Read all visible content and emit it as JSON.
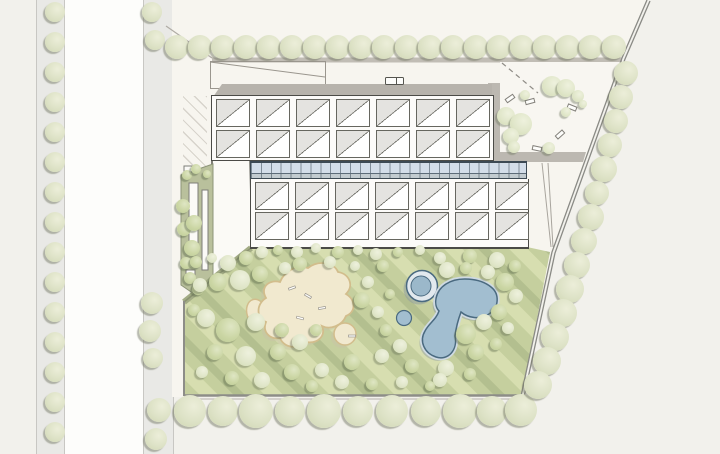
{
  "meta": {
    "drawing_type": "architectural site plan",
    "title": "",
    "visible_text": "none"
  },
  "palette": {
    "background": "#f2f1ec",
    "between_roads": "#fdfdfb",
    "road": "#e9e9e6",
    "road_edge": "#c8c7c3",
    "parcel": "#f7f5ef",
    "boundary_bar": "#c1bdb5",
    "roof_band": "#b7b3ac",
    "building_bg": "#fcfbf9",
    "outline": "#4b4b47",
    "skylight_gray": "#e4e3e0",
    "glazing_blue_top": "#d3dde9",
    "glazing_blue_bottom": "#c2cbd0",
    "court_floor": "#f8f6f1",
    "court_band": "#bcb8b1",
    "lawn_light": "#d7deb0",
    "lawn_mid": "#c5cf9e",
    "lawn_dark": "#b3bf8f",
    "sand_fill": "#f1e9cf",
    "sand_edge": "#d2bd8c",
    "pond_fill": "#a2bed0",
    "pond_rim": "#cfdae2",
    "pond_edge": "#4a6a80",
    "pool_ring": "#e2e9ee",
    "pool_inner": "#9bb8ca",
    "planting_strip": "#b9c09c"
  },
  "roads": [
    {
      "name": "street-west-outer",
      "x": 36,
      "w": 27
    },
    {
      "name": "street-west-inner",
      "x": 143,
      "w": 29
    }
  ],
  "between_roads": {
    "x": 63,
    "w": 80
  },
  "ground": {
    "parcel_points": "172,0 647,0 622,58 552,252 521,397 172,397",
    "boundary_a": "647,0 622,58 552,252 521,396",
    "boundary_b": "650,1 625,59 555,253 524,397",
    "nw_corner_line": {
      "x1": 166,
      "y1": 26,
      "x2": 212,
      "y2": 58
    },
    "top_bar": {
      "x": 212,
      "y": 57.5,
      "w": 410,
      "h": 5
    },
    "court_floor_points": "500,62 621,62 585,157 500,157",
    "court_band_left": "488,83 500,83 500,162 488,162",
    "court_band_bottom": "488,152 586,152 583,162 488,162",
    "court_dashed_path": {
      "x1": 502,
      "y1": 63,
      "x2": 538,
      "y2": 93
    },
    "wedge_lines": [
      {
        "x1": 542,
        "y1": 163,
        "x2": 551,
        "y2": 247
      },
      {
        "x1": 548,
        "y1": 163,
        "x2": 553,
        "y2": 247
      }
    ],
    "west_wing_points": "212,158 250,158 252,248 212,278",
    "strip_points": "181,175 213,164 213,281 197,296 181,285",
    "strip_slots": [
      [
        189,
        183,
        9,
        60
      ],
      [
        202,
        190,
        6,
        80
      ],
      [
        184,
        166,
        8,
        6
      ],
      [
        186,
        270,
        9,
        7
      ],
      [
        194,
        281,
        9,
        7
      ]
    ],
    "annotation_diagonal": {
      "x1": 210,
      "y1": 62,
      "x2": 325,
      "y2": 77
    },
    "lawn_points": "252,247 527,247 550,252 522,396 184,396 184,302",
    "lawn_edges": {
      "diagonal": {
        "x1": 251,
        "y1": 248,
        "x2": 184,
        "y2": 302
      },
      "bottom": {
        "x1": 184,
        "y1": 395.5,
        "x2": 522,
        "y2": 395.5
      },
      "bottom2": {
        "x1": 184,
        "y1": 399,
        "x2": 521,
        "y2": 399
      },
      "left": {
        "x1": 184,
        "y1": 301,
        "x2": 184,
        "y2": 396
      }
    },
    "sand_arm": {
      "cx": 257,
      "cy": 313,
      "rx": 10,
      "ry": 14,
      "rot": -18
    },
    "sand_path": "M266,298 C260,288 268,279 280,282 C284,272 296,264 308,268 C318,260 334,262 338,272 C350,274 354,286 346,294 C356,300 356,312 346,316 C342,326 330,330 322,326 C326,336 318,344 306,342 C298,350 284,348 280,338 C270,340 262,332 266,322 C256,318 256,304 266,298 Z",
    "sand_circle": {
      "cx": 345,
      "cy": 334,
      "r": 11
    },
    "sand_dashes": [
      [
        292,
        288,
        -20
      ],
      [
        308,
        296,
        30
      ],
      [
        322,
        308,
        -10
      ],
      [
        300,
        318,
        15
      ],
      [
        352,
        336,
        0
      ]
    ],
    "pond_path": "M446,284 C458,276 480,278 491,287 C500,294 499,308 489,314 C480,320 468,318 461,312 C458,320 456,328 455,336 C458,350 448,361 436,357 C424,353 419,341 425,331 C429,323 436,320 439,311 C433,305 435,291 446,284 Z",
    "pool_ring": {
      "cx": 422,
      "cy": 286,
      "r_outer": 15.5,
      "r_inner": 10
    },
    "pond_small": {
      "cx": 404,
      "cy": 318,
      "r": 7.5
    }
  },
  "building": {
    "annotation_rect": {
      "x": 210,
      "y": 61,
      "w": 114,
      "h": 26
    },
    "roof_vent": {
      "x": 385,
      "y": 77,
      "w": 17,
      "h": 6
    },
    "block_a": {
      "x": 211,
      "y": 95,
      "x0": 4,
      "y0": 3,
      "cell_w": 32,
      "cell_h": 26,
      "pitch_x": 40,
      "pitch_y": 31,
      "cols": 7,
      "rows": 2
    },
    "block_b": {
      "x": 250,
      "y": 179,
      "x0": 4,
      "y0": 3,
      "cell_w": 32,
      "cell_h": 26,
      "pitch_x": 40,
      "pitch_y": 30,
      "cols": 7,
      "rows": 2
    }
  },
  "benches": [
    [
      509,
      97,
      -35
    ],
    [
      529,
      100,
      -15
    ],
    [
      571,
      106,
      22
    ],
    [
      559,
      133,
      -42
    ],
    [
      536,
      147,
      12
    ]
  ],
  "trees": [
    {
      "group": "street-trees-outer",
      "tone": "street",
      "items": [
        [
          55,
          12,
          10
        ],
        [
          55,
          42,
          10
        ],
        [
          55,
          72,
          10
        ],
        [
          55,
          102,
          10
        ],
        [
          55,
          132,
          10
        ],
        [
          55,
          162,
          10
        ],
        [
          55,
          192,
          10
        ],
        [
          55,
          222,
          10
        ],
        [
          55,
          252,
          10
        ],
        [
          55,
          282,
          10
        ],
        [
          55,
          312,
          10
        ],
        [
          55,
          342,
          10
        ],
        [
          55,
          372,
          10
        ],
        [
          55,
          402,
          10
        ],
        [
          55,
          432,
          10
        ]
      ]
    },
    {
      "group": "street-trees-inner",
      "tone": "street",
      "items": [
        [
          152,
          12,
          10
        ],
        [
          155,
          40,
          10
        ],
        [
          152,
          303,
          11
        ],
        [
          150,
          331,
          11
        ],
        [
          153,
          358,
          10
        ],
        [
          159,
          410,
          12
        ],
        [
          156,
          439,
          11
        ]
      ]
    },
    {
      "group": "tree-row-north",
      "tone": "street",
      "items": [
        [
          177,
          47,
          12
        ],
        [
          200,
          47,
          12
        ],
        [
          223,
          47,
          12
        ],
        [
          246,
          47,
          12
        ],
        [
          269,
          47,
          12
        ],
        [
          292,
          47,
          12
        ],
        [
          315,
          47,
          12
        ],
        [
          338,
          47,
          12
        ],
        [
          361,
          47,
          12
        ],
        [
          384,
          47,
          12
        ],
        [
          407,
          47,
          12
        ],
        [
          430,
          47,
          12
        ],
        [
          453,
          47,
          12
        ],
        [
          476,
          47,
          12
        ],
        [
          499,
          47,
          12
        ],
        [
          522,
          47,
          12
        ],
        [
          545,
          47,
          12
        ],
        [
          568,
          47,
          12
        ],
        [
          591,
          47,
          12
        ],
        [
          614,
          47,
          12
        ]
      ]
    },
    {
      "group": "tree-row-south",
      "tone": "street",
      "items": [
        [
          190,
          411,
          16
        ],
        [
          223,
          411,
          15
        ],
        [
          256,
          411,
          17
        ],
        [
          290,
          411,
          15
        ],
        [
          324,
          411,
          17
        ],
        [
          358,
          411,
          15
        ],
        [
          392,
          411,
          16
        ],
        [
          426,
          411,
          15
        ],
        [
          460,
          411,
          17
        ],
        [
          492,
          411,
          15
        ],
        [
          521,
          410,
          16
        ]
      ]
    },
    {
      "group": "tree-row-east-boundary",
      "tone": "street",
      "items": [
        [
          626,
          73,
          12
        ],
        [
          621,
          97,
          12
        ],
        [
          616,
          121,
          12
        ],
        [
          610,
          145,
          12
        ],
        [
          604,
          169,
          13
        ],
        [
          597,
          193,
          12
        ],
        [
          591,
          217,
          13
        ],
        [
          584,
          241,
          13
        ],
        [
          577,
          265,
          13
        ],
        [
          570,
          289,
          14
        ],
        [
          563,
          313,
          14
        ],
        [
          555,
          337,
          14
        ],
        [
          547,
          361,
          14
        ],
        [
          538,
          385,
          14
        ]
      ]
    },
    {
      "group": "courtyard-trees",
      "tone": "pale",
      "items": [
        [
          552,
          86,
          10
        ],
        [
          566,
          88,
          9
        ],
        [
          578,
          96,
          6
        ],
        [
          525,
          95,
          5
        ],
        [
          506,
          116,
          9
        ],
        [
          521,
          124,
          11
        ],
        [
          511,
          136,
          8
        ],
        [
          514,
          147,
          6
        ],
        [
          549,
          148,
          6
        ],
        [
          566,
          112,
          5
        ],
        [
          583,
          104,
          4
        ]
      ]
    },
    {
      "group": "planting-strip-trees",
      "tone": "mid",
      "items": [
        [
          187,
          175,
          5
        ],
        [
          196,
          169,
          5
        ],
        [
          183,
          206,
          7
        ],
        [
          184,
          229,
          7
        ],
        [
          194,
          223,
          8
        ],
        [
          192,
          248,
          8
        ],
        [
          186,
          263,
          6
        ],
        [
          190,
          278,
          6
        ],
        [
          198,
          289,
          6
        ],
        [
          207,
          174,
          4
        ]
      ]
    },
    {
      "group": "lawn-trees",
      "tone": "mix",
      "items": [
        [
          262,
          252,
          6,
          "pale"
        ],
        [
          278,
          250,
          5,
          "mid"
        ],
        [
          297,
          252,
          6,
          "pale"
        ],
        [
          316,
          248,
          5,
          "pale"
        ],
        [
          338,
          252,
          6,
          "mid"
        ],
        [
          358,
          250,
          5,
          "pale"
        ],
        [
          376,
          254,
          6,
          "pale"
        ],
        [
          398,
          252,
          5,
          "mid"
        ],
        [
          420,
          250,
          5,
          "pale"
        ],
        [
          300,
          264,
          7,
          "mid"
        ],
        [
          330,
          262,
          6,
          "pale"
        ],
        [
          355,
          266,
          5,
          "pale"
        ],
        [
          383,
          266,
          6,
          "mid"
        ],
        [
          440,
          258,
          6,
          "pale"
        ],
        [
          470,
          256,
          7,
          "mid"
        ],
        [
          497,
          260,
          8,
          "pale"
        ],
        [
          515,
          266,
          6,
          "mid"
        ],
        [
          196,
          262,
          6,
          "mid"
        ],
        [
          212,
          258,
          5,
          "pale"
        ],
        [
          228,
          263,
          8,
          "pale"
        ],
        [
          246,
          258,
          7,
          "mid"
        ],
        [
          200,
          285,
          7,
          "pale"
        ],
        [
          218,
          282,
          9,
          "mid"
        ],
        [
          240,
          280,
          10,
          "pale"
        ],
        [
          260,
          274,
          8,
          "mid"
        ],
        [
          194,
          310,
          6,
          "mid"
        ],
        [
          206,
          318,
          9,
          "pale"
        ],
        [
          228,
          330,
          12,
          "mid"
        ],
        [
          256,
          322,
          9,
          "pale"
        ],
        [
          215,
          352,
          8,
          "mid"
        ],
        [
          246,
          356,
          10,
          "pale"
        ],
        [
          278,
          352,
          8,
          "mid"
        ],
        [
          202,
          372,
          6,
          "pale"
        ],
        [
          232,
          378,
          7,
          "mid"
        ],
        [
          262,
          380,
          8,
          "pale"
        ],
        [
          285,
          268,
          6,
          "pale"
        ],
        [
          282,
          330,
          7,
          "mid"
        ],
        [
          300,
          342,
          8,
          "pale"
        ],
        [
          316,
          330,
          6,
          "mid"
        ],
        [
          292,
          372,
          8,
          "mid"
        ],
        [
          322,
          370,
          7,
          "pale"
        ],
        [
          352,
          362,
          8,
          "mid"
        ],
        [
          382,
          356,
          7,
          "pale"
        ],
        [
          362,
          300,
          8,
          "mid"
        ],
        [
          378,
          312,
          6,
          "pale"
        ],
        [
          368,
          282,
          6,
          "pale"
        ],
        [
          390,
          294,
          5,
          "mid"
        ],
        [
          386,
          330,
          6,
          "mid"
        ],
        [
          400,
          346,
          7,
          "pale"
        ],
        [
          447,
          270,
          8,
          "pale"
        ],
        [
          466,
          268,
          6,
          "mid"
        ],
        [
          488,
          272,
          7,
          "pale"
        ],
        [
          505,
          282,
          9,
          "mid"
        ],
        [
          516,
          296,
          7,
          "pale"
        ],
        [
          499,
          312,
          8,
          "mid"
        ],
        [
          508,
          328,
          6,
          "pale"
        ],
        [
          484,
          322,
          8,
          "pale"
        ],
        [
          466,
          334,
          10,
          "mid"
        ],
        [
          446,
          368,
          8,
          "pale"
        ],
        [
          476,
          352,
          8,
          "mid"
        ],
        [
          412,
          366,
          7,
          "mid"
        ],
        [
          440,
          380,
          7,
          "pale"
        ],
        [
          470,
          374,
          6,
          "mid"
        ],
        [
          496,
          344,
          6,
          "mid"
        ],
        [
          312,
          386,
          6,
          "mid"
        ],
        [
          342,
          382,
          7,
          "pale"
        ],
        [
          372,
          384,
          6,
          "mid"
        ],
        [
          402,
          382,
          6,
          "pale"
        ],
        [
          430,
          386,
          5,
          "mid"
        ]
      ]
    }
  ]
}
